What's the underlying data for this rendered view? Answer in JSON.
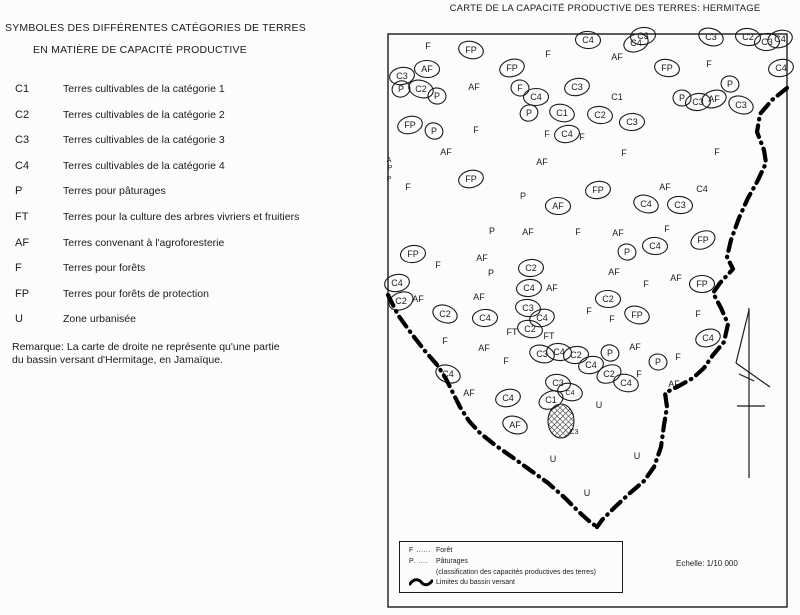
{
  "left_panel": {
    "title_line1": "SYMBOLES DES DIFFÉRENTES CATÉGORIES DE TERRES",
    "title_line2": "EN MATIÈRE DE CAPACITÉ PRODUCTIVE",
    "items": [
      {
        "symbol": "C1",
        "label": "Terres cultivables de la catégorie 1"
      },
      {
        "symbol": "C2",
        "label": "Terres cultivables de la catégorie 2"
      },
      {
        "symbol": "C3",
        "label": "Terres cultivables de la catégorie 3"
      },
      {
        "symbol": "C4",
        "label": "Terres cultivables de la catégorie 4"
      },
      {
        "symbol": "P",
        "label": "Terres pour pâturages"
      },
      {
        "symbol": "FT",
        "label": "Terres pour la culture des arbres vivriers et fruitiers"
      },
      {
        "symbol": "AF",
        "label": "Terres convenant à l'agroforesterie"
      },
      {
        "symbol": "F",
        "label": "Terres pour forêts"
      },
      {
        "symbol": "FP",
        "label": "Terres pour forêts de protection"
      },
      {
        "symbol": "U",
        "label": "Zone urbanisée"
      }
    ],
    "remark_line1": "Remarque: La carte de droite ne représente qu'une partie",
    "remark_line2": "du bassin versant d'Hermitage, en Jamaïque."
  },
  "map": {
    "title": "CARTE DE LA CAPACITÉ PRODUCTIVE DES TERRES: HERMITAGE",
    "ink": "#1b1b1b",
    "frame": {
      "x": 388,
      "y": 34,
      "w": 399,
      "h": 573
    },
    "scale_text": "Echelle: 1/10 000",
    "inset_legend": {
      "rows": [
        {
          "symbol": "F ......",
          "label": "Forêt"
        },
        {
          "symbol": "P. ....",
          "label": "Pâturages"
        },
        {
          "symbol": "",
          "label": "(classification des capacités productives des terres)"
        },
        {
          "symbol": "",
          "label": "Limites du bassin versant"
        }
      ]
    },
    "watershed": {
      "right_branch": [
        [
          787,
          88
        ],
        [
          772,
          100
        ],
        [
          760,
          114
        ],
        [
          757,
          132
        ],
        [
          764,
          150
        ],
        [
          766,
          163
        ],
        [
          757,
          182
        ],
        [
          748,
          198
        ],
        [
          739,
          218
        ],
        [
          731,
          240
        ],
        [
          727,
          257
        ],
        [
          733,
          269
        ],
        [
          720,
          283
        ],
        [
          713,
          293
        ],
        [
          721,
          308
        ],
        [
          728,
          324
        ],
        [
          724,
          342
        ],
        [
          713,
          355
        ],
        [
          704,
          368
        ],
        [
          693,
          378
        ],
        [
          677,
          387
        ],
        [
          665,
          393
        ],
        [
          667,
          407
        ],
        [
          664,
          425
        ],
        [
          661,
          447
        ],
        [
          654,
          467
        ],
        [
          644,
          481
        ],
        [
          630,
          493
        ],
        [
          615,
          507
        ],
        [
          602,
          520
        ],
        [
          597,
          527
        ]
      ],
      "left_branch": [
        [
          388,
          295
        ],
        [
          398,
          315
        ],
        [
          411,
          333
        ],
        [
          425,
          351
        ],
        [
          438,
          366
        ],
        [
          446,
          379
        ],
        [
          453,
          393
        ],
        [
          460,
          407
        ],
        [
          469,
          421
        ],
        [
          480,
          433
        ],
        [
          495,
          445
        ],
        [
          512,
          457
        ],
        [
          530,
          470
        ],
        [
          548,
          483
        ],
        [
          565,
          498
        ],
        [
          579,
          512
        ],
        [
          589,
          521
        ],
        [
          597,
          527
        ]
      ]
    },
    "hatched_zone": {
      "cx": 561,
      "cy": 421,
      "rx": 13,
      "ry": 17
    },
    "labels": [
      [
        "F",
        428,
        46,
        0
      ],
      [
        "FP",
        471,
        50,
        1
      ],
      [
        "AF",
        427,
        69,
        1
      ],
      [
        "C3",
        402,
        76,
        1
      ],
      [
        "P",
        401,
        89,
        1
      ],
      [
        "C2",
        421,
        89,
        1
      ],
      [
        "P",
        437,
        96,
        1
      ],
      [
        "AF",
        474,
        87,
        0
      ],
      [
        "FP",
        512,
        68,
        1
      ],
      [
        "F",
        548,
        54,
        0
      ],
      [
        "F",
        520,
        88,
        1
      ],
      [
        "C4",
        536,
        97,
        1
      ],
      [
        "C3",
        577,
        87,
        1
      ],
      [
        "P",
        529,
        113,
        1
      ],
      [
        "C1",
        562,
        113,
        1
      ],
      [
        "C4",
        588,
        40,
        1
      ],
      [
        "C3",
        643,
        36,
        1
      ],
      [
        "C4",
        636,
        43,
        1
      ],
      [
        "C3",
        711,
        37,
        1
      ],
      [
        "C2",
        748,
        37,
        1
      ],
      [
        "C3",
        767,
        42,
        1
      ],
      [
        "C4",
        780,
        39,
        1
      ],
      [
        "AF",
        617,
        57,
        0
      ],
      [
        "FP",
        667,
        68,
        1
      ],
      [
        "F",
        709,
        64,
        0
      ],
      [
        "C4",
        781,
        68,
        1
      ],
      [
        "C1",
        617,
        97,
        0
      ],
      [
        "P",
        730,
        84,
        1
      ],
      [
        "P",
        682,
        98,
        1
      ],
      [
        "C3",
        698,
        102,
        1
      ],
      [
        "AF",
        714,
        99,
        1
      ],
      [
        "C3",
        741,
        105,
        1
      ],
      [
        "C2",
        600,
        115,
        1
      ],
      [
        "C3",
        632,
        122,
        1
      ],
      [
        "FP",
        410,
        125,
        1
      ],
      [
        "P",
        434,
        131,
        1
      ],
      [
        "F",
        476,
        130,
        0
      ],
      [
        "F",
        547,
        134,
        0
      ],
      [
        "C4",
        567,
        134,
        1
      ],
      [
        "F",
        582,
        137,
        0
      ],
      [
        "AF",
        446,
        152,
        0
      ],
      [
        "F",
        624,
        153,
        0
      ],
      [
        "F",
        717,
        152,
        0
      ],
      [
        "A",
        389,
        159,
        0,
        7
      ],
      [
        "P",
        390,
        167,
        0,
        7
      ],
      [
        "P",
        389,
        178,
        0,
        7
      ],
      [
        "F",
        408,
        187,
        0
      ],
      [
        "FP",
        471,
        179,
        1
      ],
      [
        "AF",
        542,
        162,
        0
      ],
      [
        "P",
        523,
        196,
        0
      ],
      [
        "AF",
        558,
        206,
        1
      ],
      [
        "FP",
        598,
        190,
        1
      ],
      [
        "AF",
        665,
        187,
        0
      ],
      [
        "C4",
        646,
        204,
        1
      ],
      [
        "C3",
        680,
        205,
        1
      ],
      [
        "C4",
        702,
        189,
        0
      ],
      [
        "F",
        578,
        232,
        0
      ],
      [
        "P",
        492,
        231,
        0
      ],
      [
        "AF",
        528,
        232,
        0
      ],
      [
        "AF",
        618,
        233,
        0
      ],
      [
        "F",
        667,
        229,
        0
      ],
      [
        "FP",
        703,
        240,
        1
      ],
      [
        "P",
        627,
        252,
        1
      ],
      [
        "C4",
        655,
        246,
        1
      ],
      [
        "FP",
        413,
        254,
        1
      ],
      [
        "F",
        438,
        265,
        0
      ],
      [
        "AF",
        482,
        258,
        0
      ],
      [
        "P",
        491,
        273,
        0
      ],
      [
        "C2",
        531,
        268,
        1
      ],
      [
        "AF",
        614,
        272,
        0
      ],
      [
        "AF",
        676,
        278,
        0
      ],
      [
        "F",
        646,
        284,
        0
      ],
      [
        "FP",
        702,
        284,
        1
      ],
      [
        "C4",
        397,
        283,
        1
      ],
      [
        "C2",
        401,
        301,
        1
      ],
      [
        "AF",
        418,
        299,
        0
      ],
      [
        "AF",
        479,
        297,
        0
      ],
      [
        "C4",
        529,
        288,
        1
      ],
      [
        "AF",
        552,
        288,
        0
      ],
      [
        "C2",
        445,
        314,
        1
      ],
      [
        "C3",
        528,
        308,
        1
      ],
      [
        "C4",
        485,
        318,
        1
      ],
      [
        "C4",
        542,
        318,
        1
      ],
      [
        "FT",
        512,
        332,
        0
      ],
      [
        "C2",
        530,
        329,
        1
      ],
      [
        "FT",
        549,
        336,
        0
      ],
      [
        "F",
        445,
        341,
        0
      ],
      [
        "AF",
        484,
        348,
        0
      ],
      [
        "C3",
        542,
        354,
        1
      ],
      [
        "C4",
        559,
        352,
        1
      ],
      [
        "C2",
        576,
        355,
        1
      ],
      [
        "F",
        506,
        361,
        0
      ],
      [
        "C4",
        448,
        374,
        1
      ],
      [
        "C3",
        558,
        383,
        1
      ],
      [
        "AF",
        469,
        393,
        0
      ],
      [
        "C4",
        508,
        398,
        1
      ],
      [
        "C1",
        551,
        400,
        1
      ],
      [
        "C4",
        570,
        392,
        1,
        7
      ],
      [
        "C2",
        608,
        299,
        1
      ],
      [
        "F",
        589,
        311,
        0
      ],
      [
        "F",
        612,
        319,
        0
      ],
      [
        "FP",
        637,
        315,
        1
      ],
      [
        "F",
        698,
        314,
        0
      ],
      [
        "AF",
        635,
        347,
        0
      ],
      [
        "C4",
        708,
        338,
        1
      ],
      [
        "P",
        610,
        353,
        1
      ],
      [
        "P",
        658,
        362,
        1
      ],
      [
        "F",
        678,
        357,
        0
      ],
      [
        "C4",
        591,
        365,
        1
      ],
      [
        "C2",
        609,
        374,
        1
      ],
      [
        "C4",
        626,
        383,
        1
      ],
      [
        "F",
        639,
        374,
        0
      ],
      [
        "AF",
        674,
        384,
        0
      ],
      [
        "U",
        599,
        405,
        0
      ],
      [
        "AF",
        515,
        425,
        1
      ],
      [
        "C3",
        574,
        431,
        0,
        7
      ],
      [
        "U",
        553,
        459,
        0
      ],
      [
        "U",
        637,
        456,
        0
      ],
      [
        "U",
        587,
        493,
        0
      ]
    ]
  }
}
